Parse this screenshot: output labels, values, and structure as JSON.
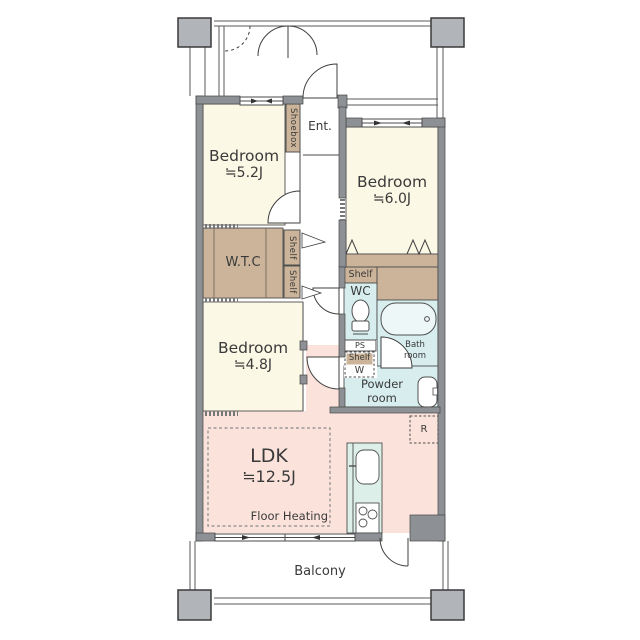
{
  "plan": {
    "bedroom_a": {
      "name": "Bedroom",
      "size": "≒5.2J"
    },
    "bedroom_b": {
      "name": "Bedroom",
      "size": "≒6.0J"
    },
    "bedroom_c": {
      "name": "Bedroom",
      "size": "≒4.8J"
    },
    "ldk": {
      "name": "LDK",
      "size": "≒12.5J",
      "floor_note": "Floor Heating"
    },
    "walk_in_closet": {
      "label": "W.T.C"
    },
    "entrance": {
      "label": "Ent."
    },
    "shoebox": {
      "label": "Shoebox"
    },
    "shelf": {
      "label": "Shelf"
    },
    "wc": {
      "label": "WC"
    },
    "pipe_space": {
      "label": "PS"
    },
    "washer": {
      "label": "W"
    },
    "bath": {
      "label": "Bath room"
    },
    "powder": {
      "label": "Powder room"
    },
    "refrigerator": {
      "label": "R"
    },
    "balcony": {
      "label": "Balcony"
    }
  },
  "colors": {
    "room_cream": "#fbf8e5",
    "closet_tan": "#cbb499",
    "wet_area_blue": "#d7edee",
    "kitchen_green": "#dcefe8",
    "ldk_pink": "#fbe3dc",
    "wall_gray": "#8d9095",
    "column_gray": "#b1b4b8",
    "line_dark": "#4a4a4a"
  }
}
